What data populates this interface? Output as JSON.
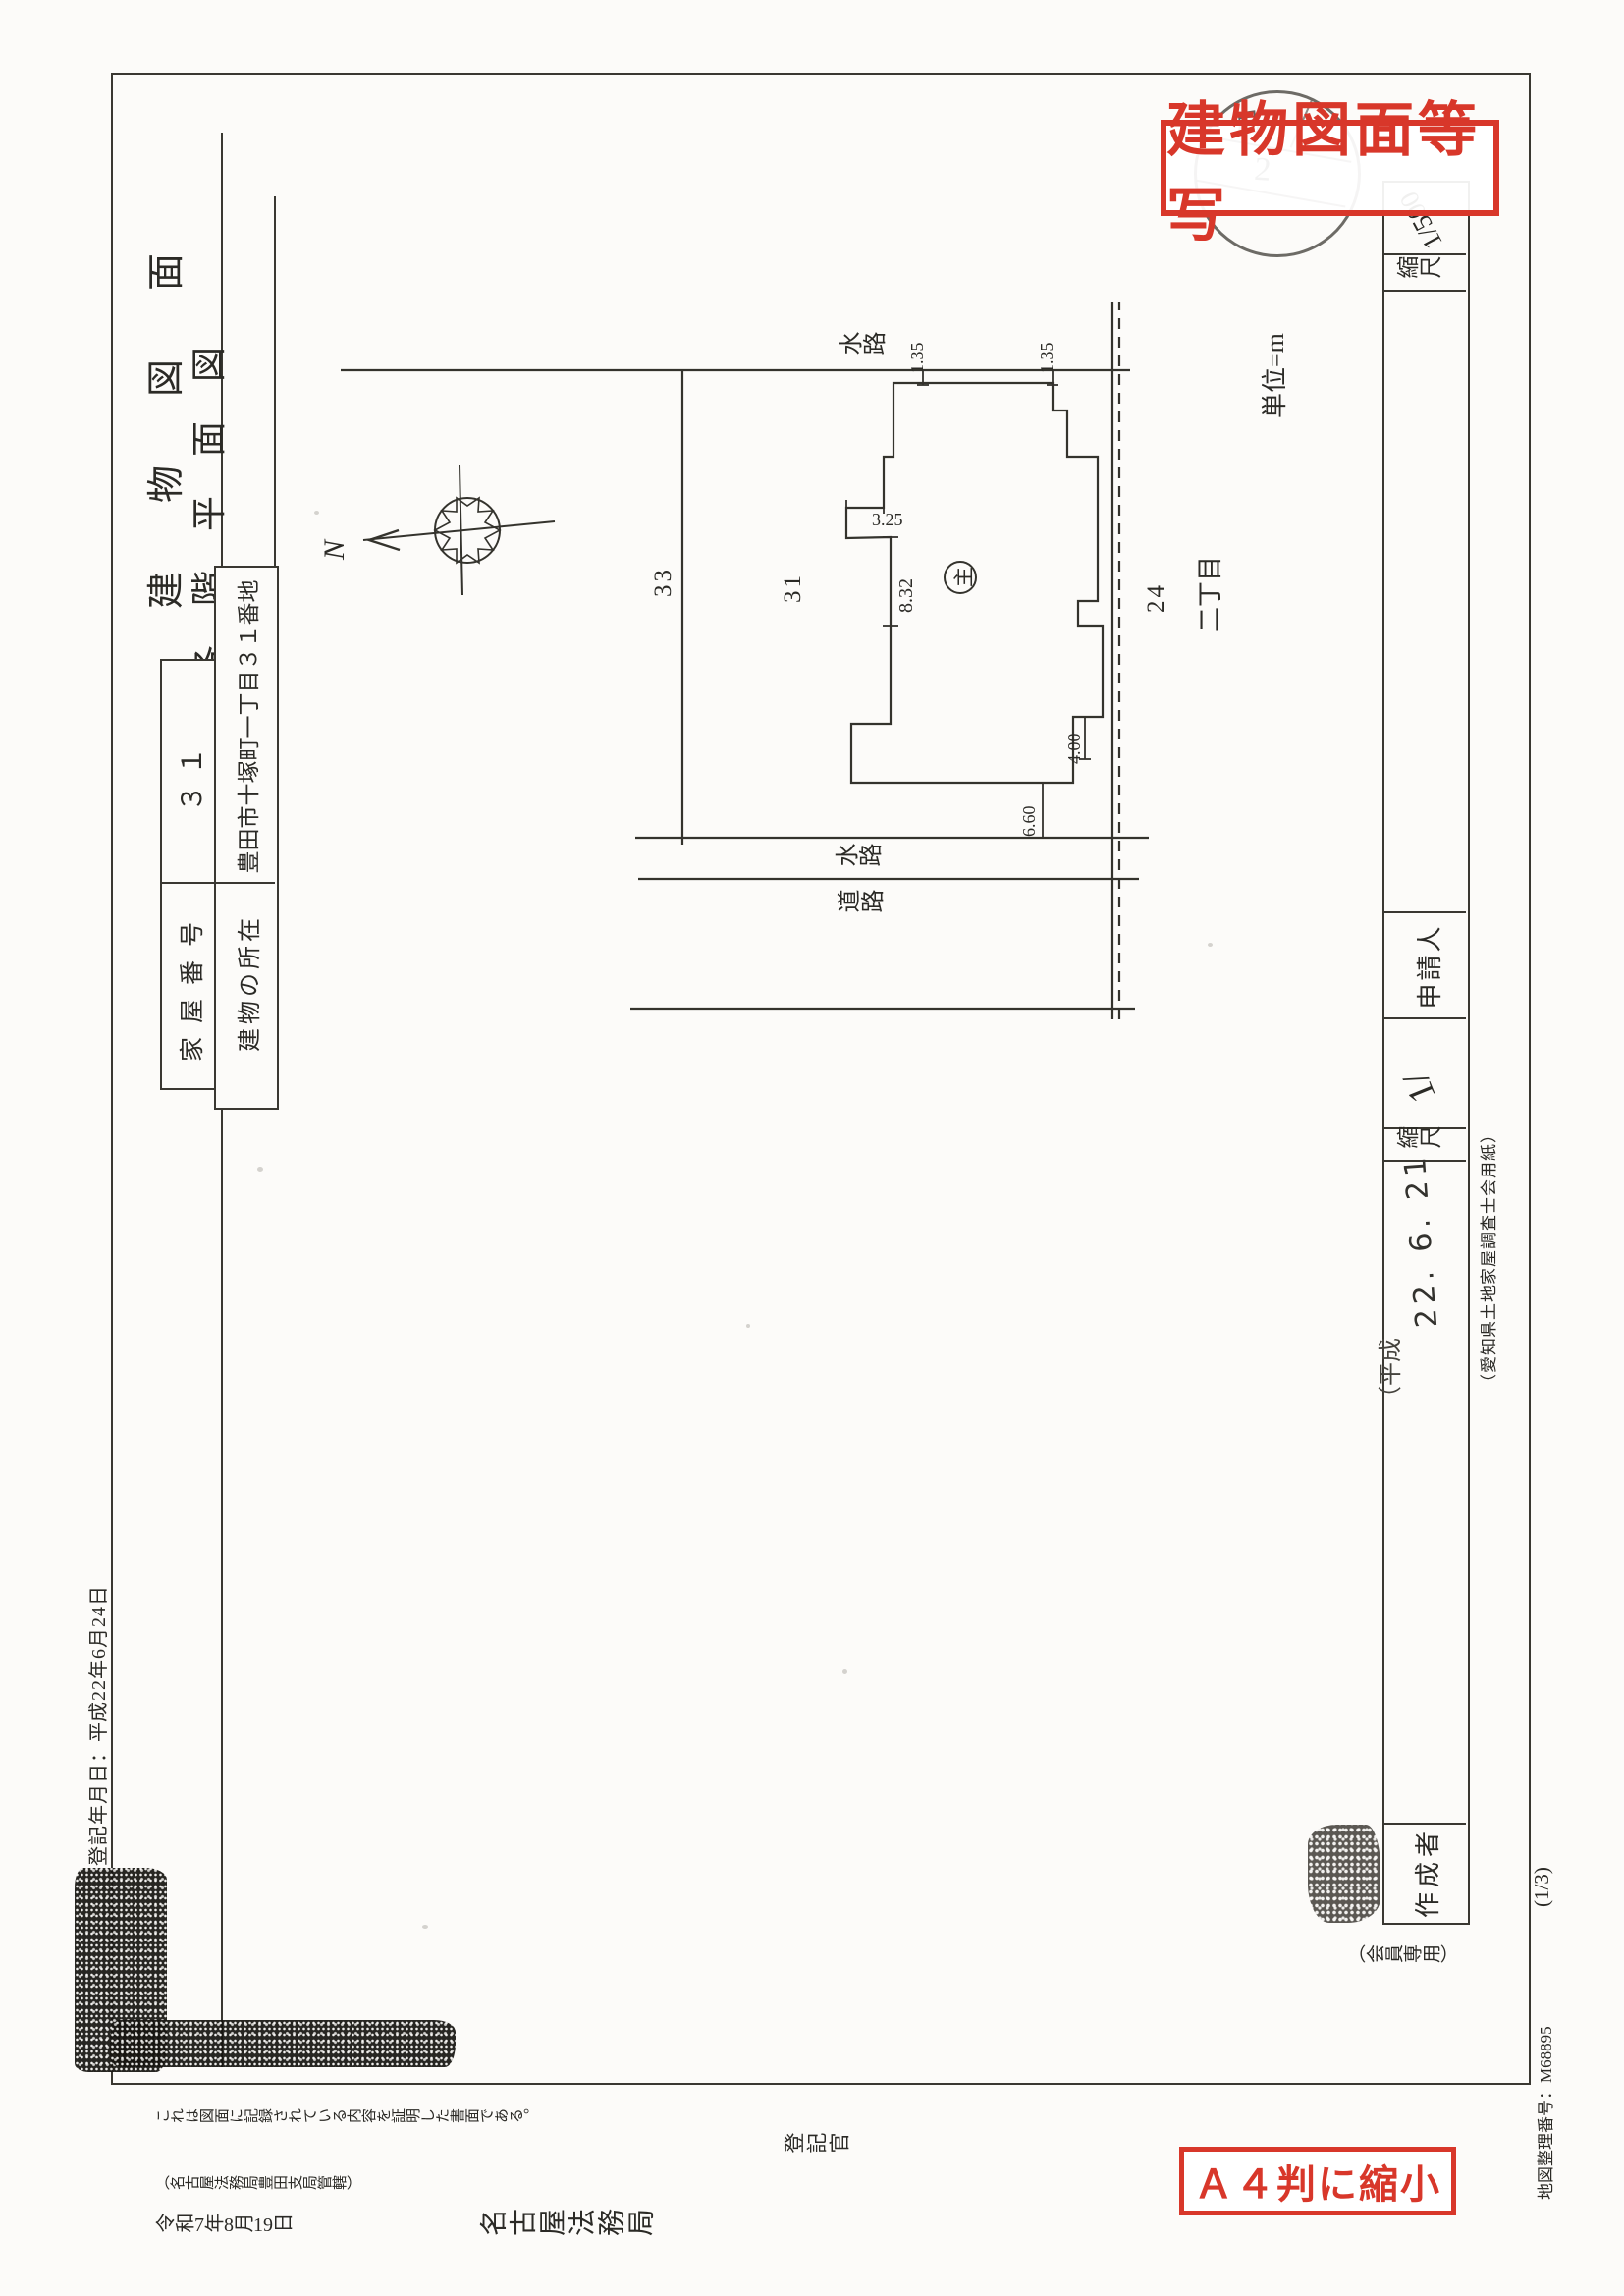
{
  "stamps": {
    "copy_label": "建物図面等写",
    "a4_label": "Ａ４判に縮小",
    "round_glyph_top": "局",
    "round_glyph_mid": "2"
  },
  "titles": {
    "building_drawing": "建物図面",
    "floor_plan": "各階平面図"
  },
  "table": {
    "rows": [
      {
        "label": "家屋番号",
        "value": "３１"
      },
      {
        "label": "建物の所在",
        "value": "豊田市十塚町一丁目３１番地"
      }
    ]
  },
  "plan": {
    "waterway_east": "水路",
    "waterway_west": "水路",
    "road_west": "道路",
    "district": "二丁目",
    "parcel_33": "33",
    "parcel_31": "31",
    "parcel_24": "24",
    "unit": "単位=m",
    "main_mark": "主",
    "dim_135_a": "1.35",
    "dim_135_b": "1.35",
    "dim_832": "8.32",
    "dim_325": "3.25",
    "dim_400": "4.00",
    "dim_660": "6.60"
  },
  "compass": {
    "north": "N"
  },
  "strip": {
    "scale_label": "縮尺",
    "scale_value": "1/500",
    "applicant_label": "申請人",
    "scale2_label": "縮尺",
    "scale2_value": "1/",
    "author_label": "作成者",
    "member_note": "（会員専用）",
    "heisei_prefix": "（平成",
    "handwritten_date": "22. 6. 21",
    "paper_note": "（愛知県土地家屋調査士会用紙）"
  },
  "margins": {
    "reg_date": "登記年月日：平成22年6月24日",
    "cert_sentence": "これは図面に記録されている内容を証明した書面である。",
    "jurisdiction": "（名古屋法務局豊田支局管轄）",
    "issue_date": "令和7年8月19日",
    "bureau": "名古屋法務局",
    "registrar": "登記官",
    "map_number": "地図整理番号：M68895",
    "page": "(1/3)"
  }
}
